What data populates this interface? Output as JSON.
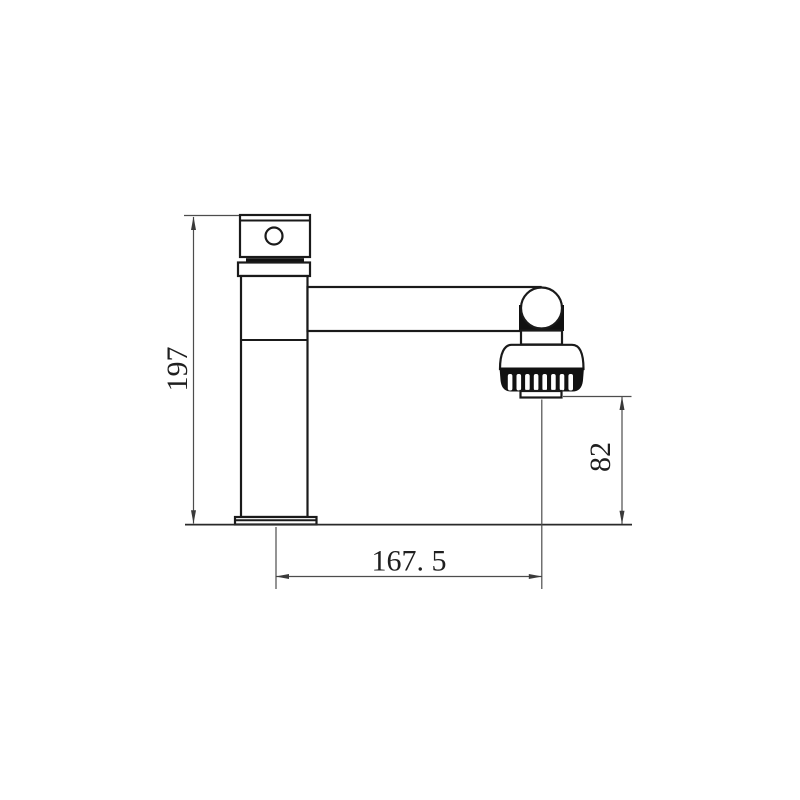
{
  "page": {
    "background": "#ffffff",
    "object_line_color": "#1a1a1a",
    "dimension_line_color": "#4d4d4d",
    "subject": "basin-faucet-side-elevation"
  },
  "dimensions": {
    "height": {
      "label": "197",
      "value": 197,
      "orientation": "vertical"
    },
    "reach": {
      "label": "167. 5",
      "value": 167.5,
      "orientation": "horizontal"
    },
    "outlet_height": {
      "label": "82",
      "value": 82,
      "orientation": "vertical"
    }
  }
}
